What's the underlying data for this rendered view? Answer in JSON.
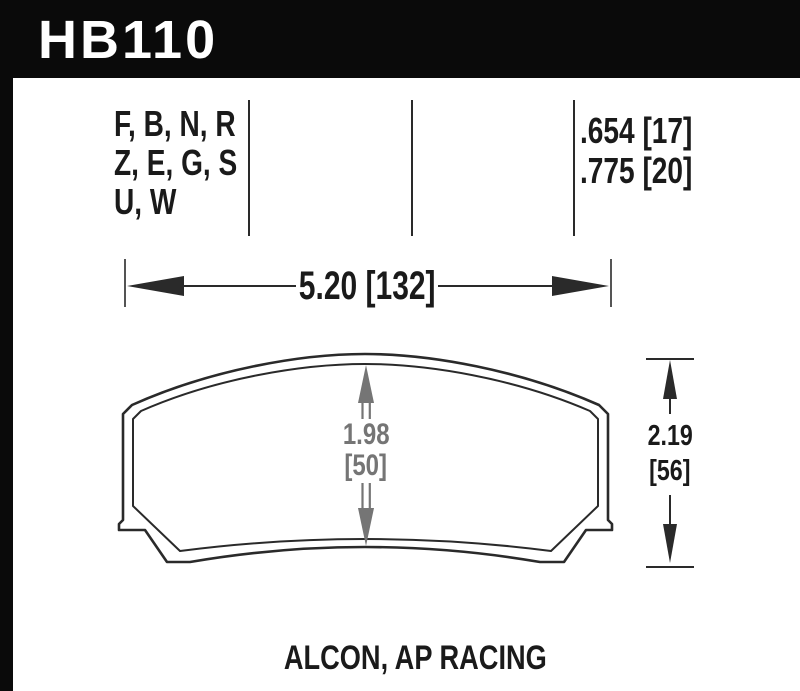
{
  "header": {
    "part_number": "HB110"
  },
  "table": {
    "compound_rows": [
      "F, B, N, R",
      "Z, E, G, S",
      "U, W"
    ],
    "thickness_rows": [
      ".654 [17]",
      ".775 [20]"
    ]
  },
  "dimensions": {
    "width": {
      "label": "5.20 [132]"
    },
    "pad_height": {
      "inches": "1.98",
      "mm": "[50]"
    },
    "height": {
      "inches": "2.19",
      "mm": "[56]"
    }
  },
  "footer": {
    "applications": "ALCON, AP RACING"
  },
  "colors": {
    "header_bg": "#0a0a0a",
    "line": "#2a2a2a",
    "dimension_gray": "#757575",
    "text": "#1a1a1a",
    "background": "#ffffff"
  }
}
